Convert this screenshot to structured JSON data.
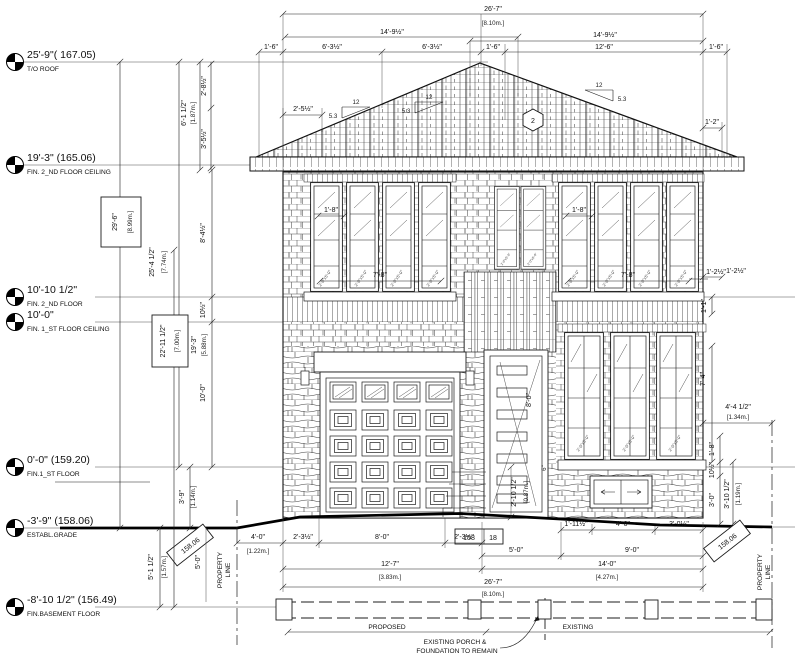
{
  "levels": [
    {
      "elev": "25'-9\"( 167.05)",
      "name": "T/O ROOF"
    },
    {
      "elev": "19'-3\" (165.06)",
      "name": "FIN. 2_ND FLOOR CEILING"
    },
    {
      "elev": "10'-10 1/2\"",
      "name": "FIN. 2_ND FLOOR"
    },
    {
      "elev": "10'-0\"",
      "name": "FIN. 1_ST FLOOR CEILING"
    },
    {
      "elev": "0'-0\" (159.20)",
      "name": "FIN.1_ST FLOOR"
    },
    {
      "elev": "-3'-9\" (158.06)",
      "name": "ESTABL.GRADE"
    },
    {
      "elev": "-8'-10 1/2\" (156.49)",
      "name": "FIN.BASEMENT FLOOR"
    }
  ],
  "top": {
    "overall": "26'-7\"",
    "overall_m": "[8.10m.]",
    "span_left": "14'-9½\"",
    "span_right": "14'-9½\"",
    "seg_16": "1'-6\"",
    "seg_635a": "6'-3½\"",
    "seg_635b": "6'-3½\"",
    "seg_126": "12'-6\""
  },
  "left": {
    "d_285": "2'-8½\"",
    "d_355": "3'-5½\"",
    "d_615": "6'-1 1/2\"",
    "d_615m": "[1.87m.]",
    "d_296": "29'-6\"",
    "d_296m": "[8.99m.]",
    "d_2545": "25'-4 1/2\"",
    "d_2545m": "[7.74m.]",
    "d_845": "8'-4½\"",
    "d_105": "10½\"",
    "d_22115": "22'-11 1/2\"",
    "d_22115m": "[7.00m.]",
    "d_193": "19'-3\"",
    "d_193m": "[5.88m.]",
    "d_100": "10'-0\"",
    "d_39": "3'-9\"",
    "d_39m": "[1.14m.]",
    "d_5112": "5'-1 1/2\"",
    "d_5112m": "[1.57m.]"
  },
  "right": {
    "d_125": "1'-2½\"",
    "d_11": "1'-1\"",
    "d_74": "7'-4\"",
    "d_4412": "4'-4 1/2\"",
    "d_4412m": "[1.34m.]",
    "d_18": "1'-8\"",
    "d_105": "10½\"",
    "d_30": "3'-0\"",
    "d_31012": "3'-10 1/2\"",
    "d_31012m": "[1.19m.]",
    "d_12": "1'-2\""
  },
  "bottom": {
    "d_40": "4'-0\"",
    "d_40m": "[1.22m.]",
    "d_235a": "2'-3½\"",
    "d_235b": "2'-3½\"",
    "d_80": "8'-0\"",
    "d_127": "12'-7\"",
    "d_127m": "[3.83m.]",
    "d_50": "5'-0\"",
    "d_90": "9'-0\"",
    "d_140": "14'-0\"",
    "d_140m": "[4.27m.]",
    "overall": "26'-7\"",
    "overall_m": "[8.10m.]",
    "d_1115": "1'-11½\"",
    "d_305": "3'-0½\""
  },
  "roof": {
    "run": "12",
    "rise": "5.3",
    "tag": "2",
    "eave_l": "2'-5½\"",
    "eave_r": "1'-2\""
  },
  "win": {
    "head": "1'-8\"",
    "width_l": "7'-8\"",
    "width_r": "7'-8\"",
    "off": "1'-2½\"",
    "sash_tag": "2'-0\"x5'-0\""
  },
  "door": {
    "height": "8'-0\"",
    "rise": "2'-10 1/2\"",
    "rise_m": "[0.87m.]",
    "d6": "6\""
  },
  "site": {
    "datum": "158",
    "datum2": "18",
    "grade_l": "158.06",
    "grade_r": "158.06",
    "prop1": "PROPERTY",
    "prop2": "LINE",
    "d50": "5'-0\"",
    "proposed": "PROPOSED",
    "existing": "EXISTING",
    "note1": "EXISTING PORCH &",
    "note2": "FOUNDATION TO REMAIN"
  }
}
